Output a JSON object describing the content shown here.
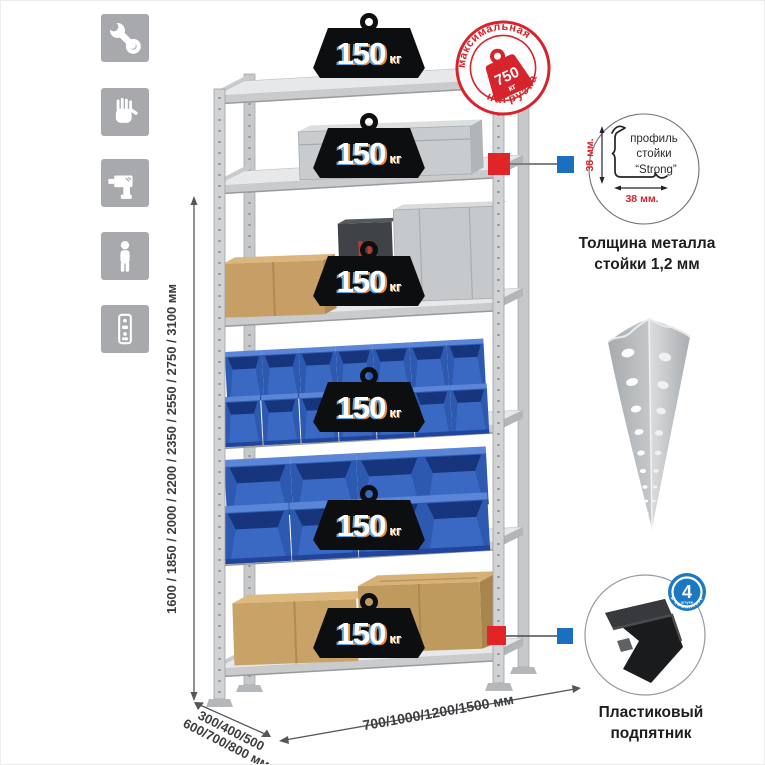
{
  "colors": {
    "accent_red": "#d7232b",
    "marker_red": "#e02428",
    "marker_blue": "#1a6fbf",
    "badge_blue": "#1b78c2",
    "icon_bg": "#a7a9ac",
    "bin_blue": "#2d59b0",
    "weight_black": "#0d0e10"
  },
  "sidebar": {
    "icons": [
      {
        "name": "wrench-icon"
      },
      {
        "name": "gloves-icon"
      },
      {
        "name": "drill-icon"
      },
      {
        "name": "person-icon"
      },
      {
        "name": "rack-post-icon"
      }
    ]
  },
  "stamp": {
    "arc_top": "максимальная",
    "arc_bottom": "нагрузка",
    "weight_value": "750",
    "weight_unit": "кг"
  },
  "shelf_badges": [
    {
      "value": "150",
      "unit": "кг"
    },
    {
      "value": "150",
      "unit": "кг"
    },
    {
      "value": "150",
      "unit": "кг"
    },
    {
      "value": "150",
      "unit": "кг"
    },
    {
      "value": "150",
      "unit": "кг"
    },
    {
      "value": "150",
      "unit": "кг"
    }
  ],
  "dims": {
    "height": "1600 / 1850 / 2000 / 2200 / 2350 / 2550 / 2750 / 3100 мм",
    "depth1": "300/400/500",
    "depth2": "600/700/800 мм",
    "width": "700/1000/1200/1500 мм"
  },
  "profile": {
    "label1": "профиль",
    "label2": "стойки",
    "label3": "“Strong”",
    "dim_vertical": "38 мм.",
    "dim_horizontal": "38 мм.",
    "caption1": "Толщина металла",
    "caption2": "стойки 1,2 мм"
  },
  "foot": {
    "badge_count": "4",
    "badge_small": "штуки",
    "badge_arc": "в комплекте",
    "caption1": "Пластиковый",
    "caption2": "подпятник"
  }
}
